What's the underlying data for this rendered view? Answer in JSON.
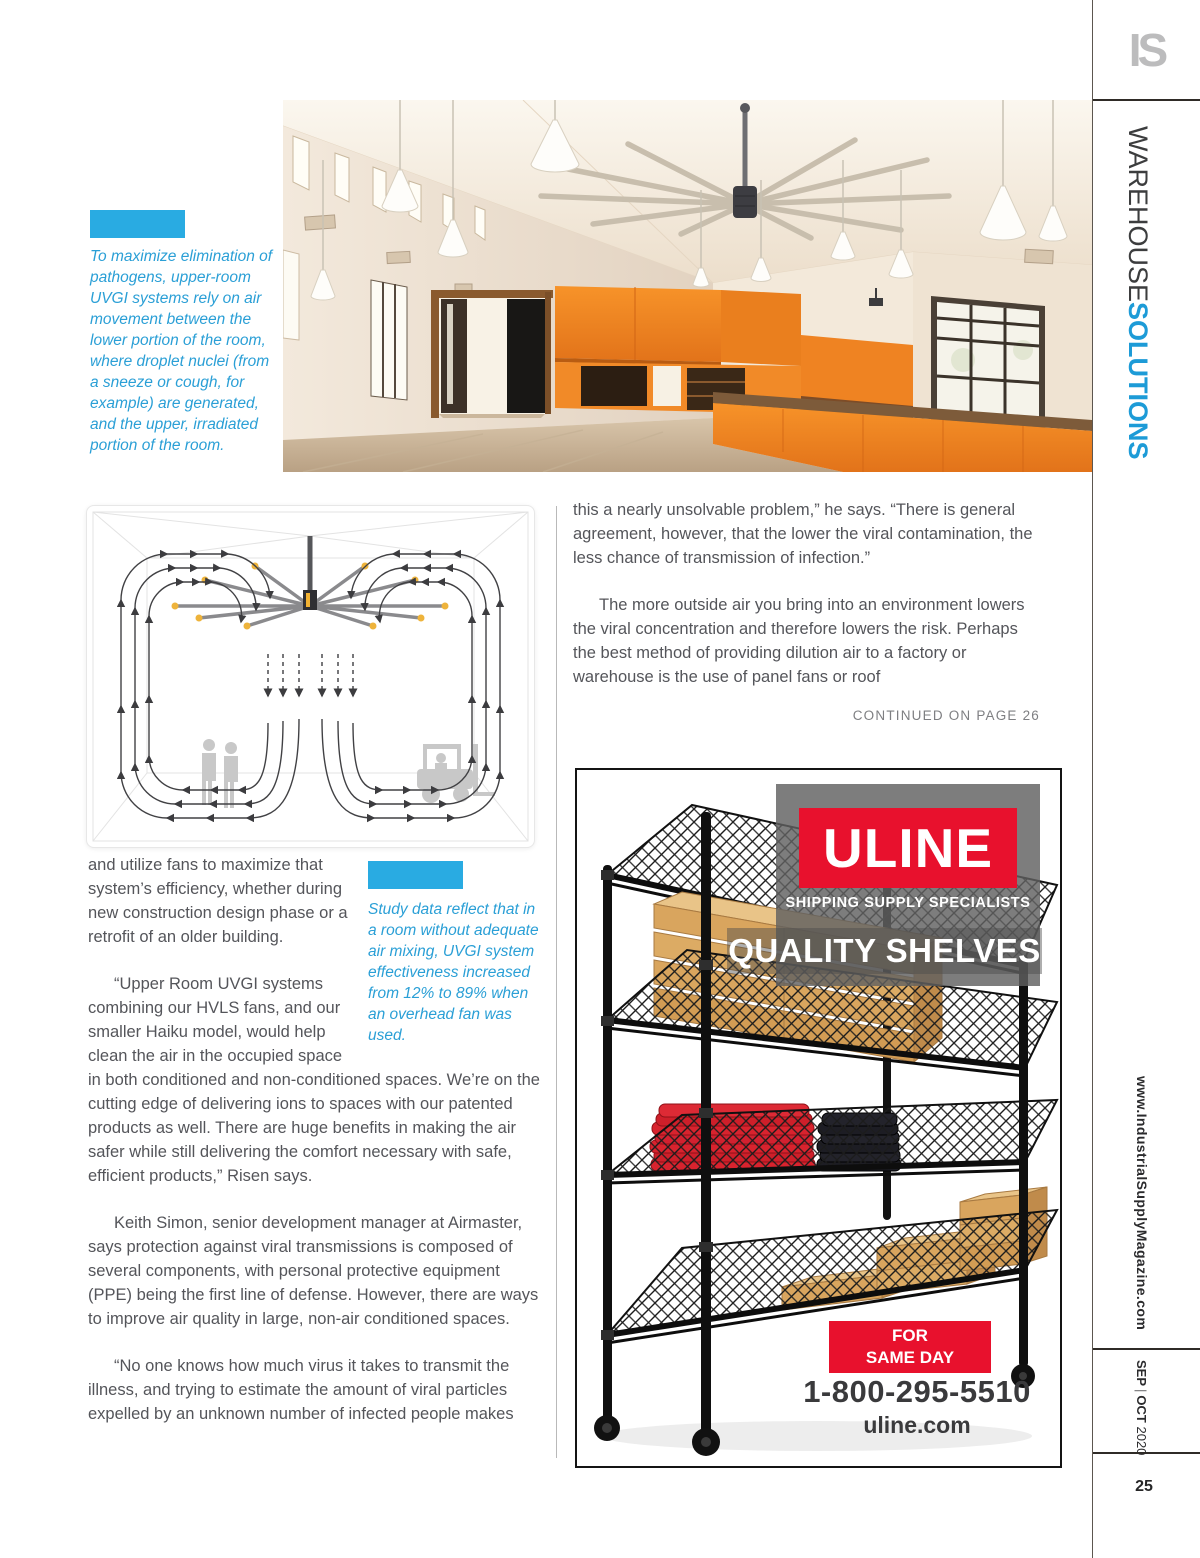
{
  "masthead": {
    "logo": "IS",
    "section_light": "WAREHOUSE",
    "section_bold": "SOLUTIONS",
    "website": "www.IndustrialSupplyMagazine.com",
    "issue": {
      "month1": "SEP",
      "divider": "|",
      "month2": "OCT",
      "year": "2020"
    },
    "page_number": "25"
  },
  "figures": {
    "photo_caption": "To maximize elimination of pathogens, upper-room UVGI systems rely on air movement between the lower portion of the room, where droplet nuclei (from a sneeze or cough, for example) are generated, and the upper, irradiated portion of the room.",
    "diagram_caption": "Study data reflect that in a room without adequate air mixing, UVGI system effectiveness increased from 12% to 89% when an overhead fan was used."
  },
  "article": {
    "right_col": {
      "p1": "this a nearly unsolvable problem,” he says. “There is general agreement, however, that the lower the viral contamination, the less chance of transmission of infection.”",
      "p2": "The more outside air you bring into an environment lowers the viral concentration and therefore lowers the risk. Perhaps the best method of providing dilution air to a factory or warehouse is the use of panel fans or roof",
      "continued": "CONTINUED ON PAGE 26"
    },
    "left_col": {
      "p1": "and utilize fans to maximize that system’s efficiency, whether during new construction design phase or a retrofit of an older building.",
      "p2": "“Upper Room UVGI systems combining our HVLS fans, and our smaller Haiku model, would help clean the air in the occupied space in both conditioned and non-conditioned spaces. We’re on the cutting edge of delivering ions to spaces with our patented products as well. There are huge benefits in making the air safer while still delivering the comfort necessary with safe, efficient products,” Risen says.",
      "p3": "Keith Simon, senior development manager at Airmaster, says protection against viral transmissions is composed of several components, with personal protective equipment (PPE) being the first line of defense. However, there are ways to improve air quality in large, non-air conditioned spaces.",
      "p4": "“No one knows how much virus it takes to transmit the illness, and trying to estimate the amount of viral particles expelled by an unknown number of infected people makes"
    }
  },
  "ad": {
    "brand": "ULINE",
    "tagline": "SHIPPING SUPPLY SPECIALISTS",
    "headline": "QUALITY SHELVES",
    "promo_line1": "ORDER BY 6 PM FOR",
    "promo_line2": "SAME DAY SHIPPING",
    "phone": "1-800-295-5510",
    "website": "uline.com"
  },
  "colors": {
    "accent_blue": "#29abe2",
    "section_blue": "#1d9bd7",
    "uline_red": "#e8112d",
    "body_text": "#54555a"
  }
}
